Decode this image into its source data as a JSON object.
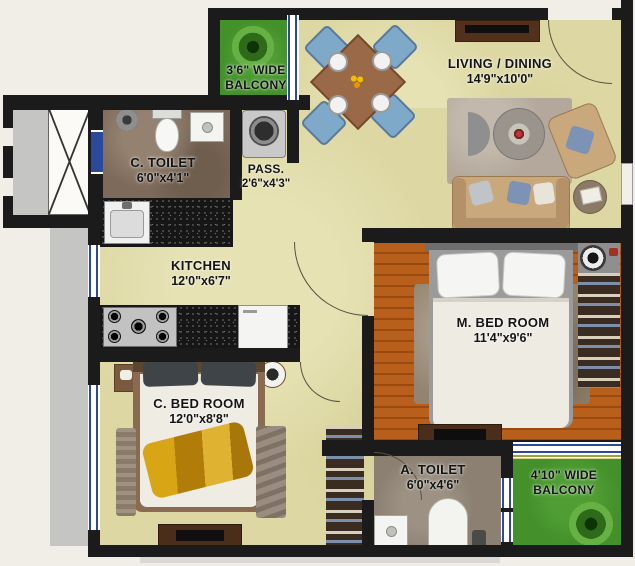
{
  "plan": {
    "title": "2BHK apartment floor plan",
    "rooms": {
      "balcony_top": {
        "line1": "3'6\" WIDE",
        "line2": "BALCONY"
      },
      "living_dining": {
        "name": "LIVING / DINING",
        "dims": "14'9\"x10'0\""
      },
      "c_toilet": {
        "name": "C. TOILET",
        "dims": "6'0\"x4'1\""
      },
      "passage": {
        "name": "PASS.",
        "dims": "2'6\"x4'3\""
      },
      "kitchen": {
        "name": "KITCHEN",
        "dims": "12'0\"x6'7\""
      },
      "m_bedroom": {
        "name": "M. BED ROOM",
        "dims": "11'4\"x9'6\""
      },
      "c_bedroom": {
        "name": "C. BED ROOM",
        "dims": "12'0\"x8'8\""
      },
      "a_toilet": {
        "name": "A. TOILET",
        "dims": "6'0\"x4'6\""
      },
      "balcony_bottom": {
        "line1": "4'10\" WIDE",
        "line2": "BALCONY"
      }
    },
    "colors": {
      "wall": "#1b1b1b",
      "floor_khaki": "#ddd8a3",
      "wood_floor": "#b2591b",
      "balcony_green": "#44912b",
      "window_blue": "#2b4a9b",
      "c_toilet_floor": "#7d6a5b",
      "a_toilet_floor": "#8b8072",
      "counter_granite": "#161616",
      "dining_chair_blue": "#7fa9c8",
      "sofa_tan": "#c9a87c",
      "gold_throw": "#cf9a12"
    }
  }
}
